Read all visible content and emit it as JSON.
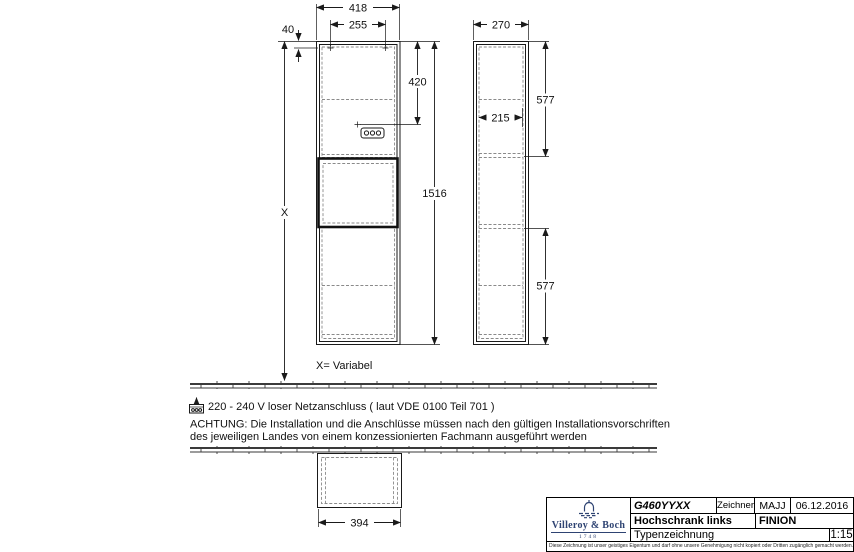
{
  "drawing": {
    "front_view": {
      "dim_width_outer": "418",
      "dim_hole_spacing": "255",
      "dim_hole_offset": "40",
      "dim_socket_height": "420",
      "dim_total_height": "1516",
      "dim_wall_distance": "X",
      "variable_note": "X= Variabel"
    },
    "side_view": {
      "dim_depth": "270",
      "dim_inner_depth": "215",
      "dim_upper_section": "577",
      "dim_lower_section": "577"
    },
    "top_view": {
      "dim_width_inner": "394"
    },
    "notes": {
      "power": "220 - 240 V loser Netzanschluss ( laut VDE 0100 Teil 701 )",
      "warning_line1": "ACHTUNG: Die Installation und die Anschlüsse müssen nach den gültigen Installationsvorschriften",
      "warning_line2": "des jeweiligen Landes von einem konzessionierten Fachmann ausgeführt werden"
    }
  },
  "title_block": {
    "logo": {
      "brand": "Villeroy & Boch",
      "year": "1748"
    },
    "article_number": "G460YYXX",
    "drafter_label": "Zeichner",
    "drafter": "MAJJ",
    "date": "06.12.2016",
    "product_name": "Hochschrank links",
    "series": "FINION",
    "drawing_type": "Typenzeichnung",
    "scale": "1:15",
    "copyright": "Diese Zeichnung ist unser geistiges Eigentum und darf ohne unsere Genehmigung nicht kopiert oder Dritten zugänglich gemacht werden."
  },
  "colors": {
    "line": "#1a1a1a",
    "dashed_line": "#8a8a8a",
    "brand_navy": "#2e4372",
    "background": "#ffffff"
  }
}
